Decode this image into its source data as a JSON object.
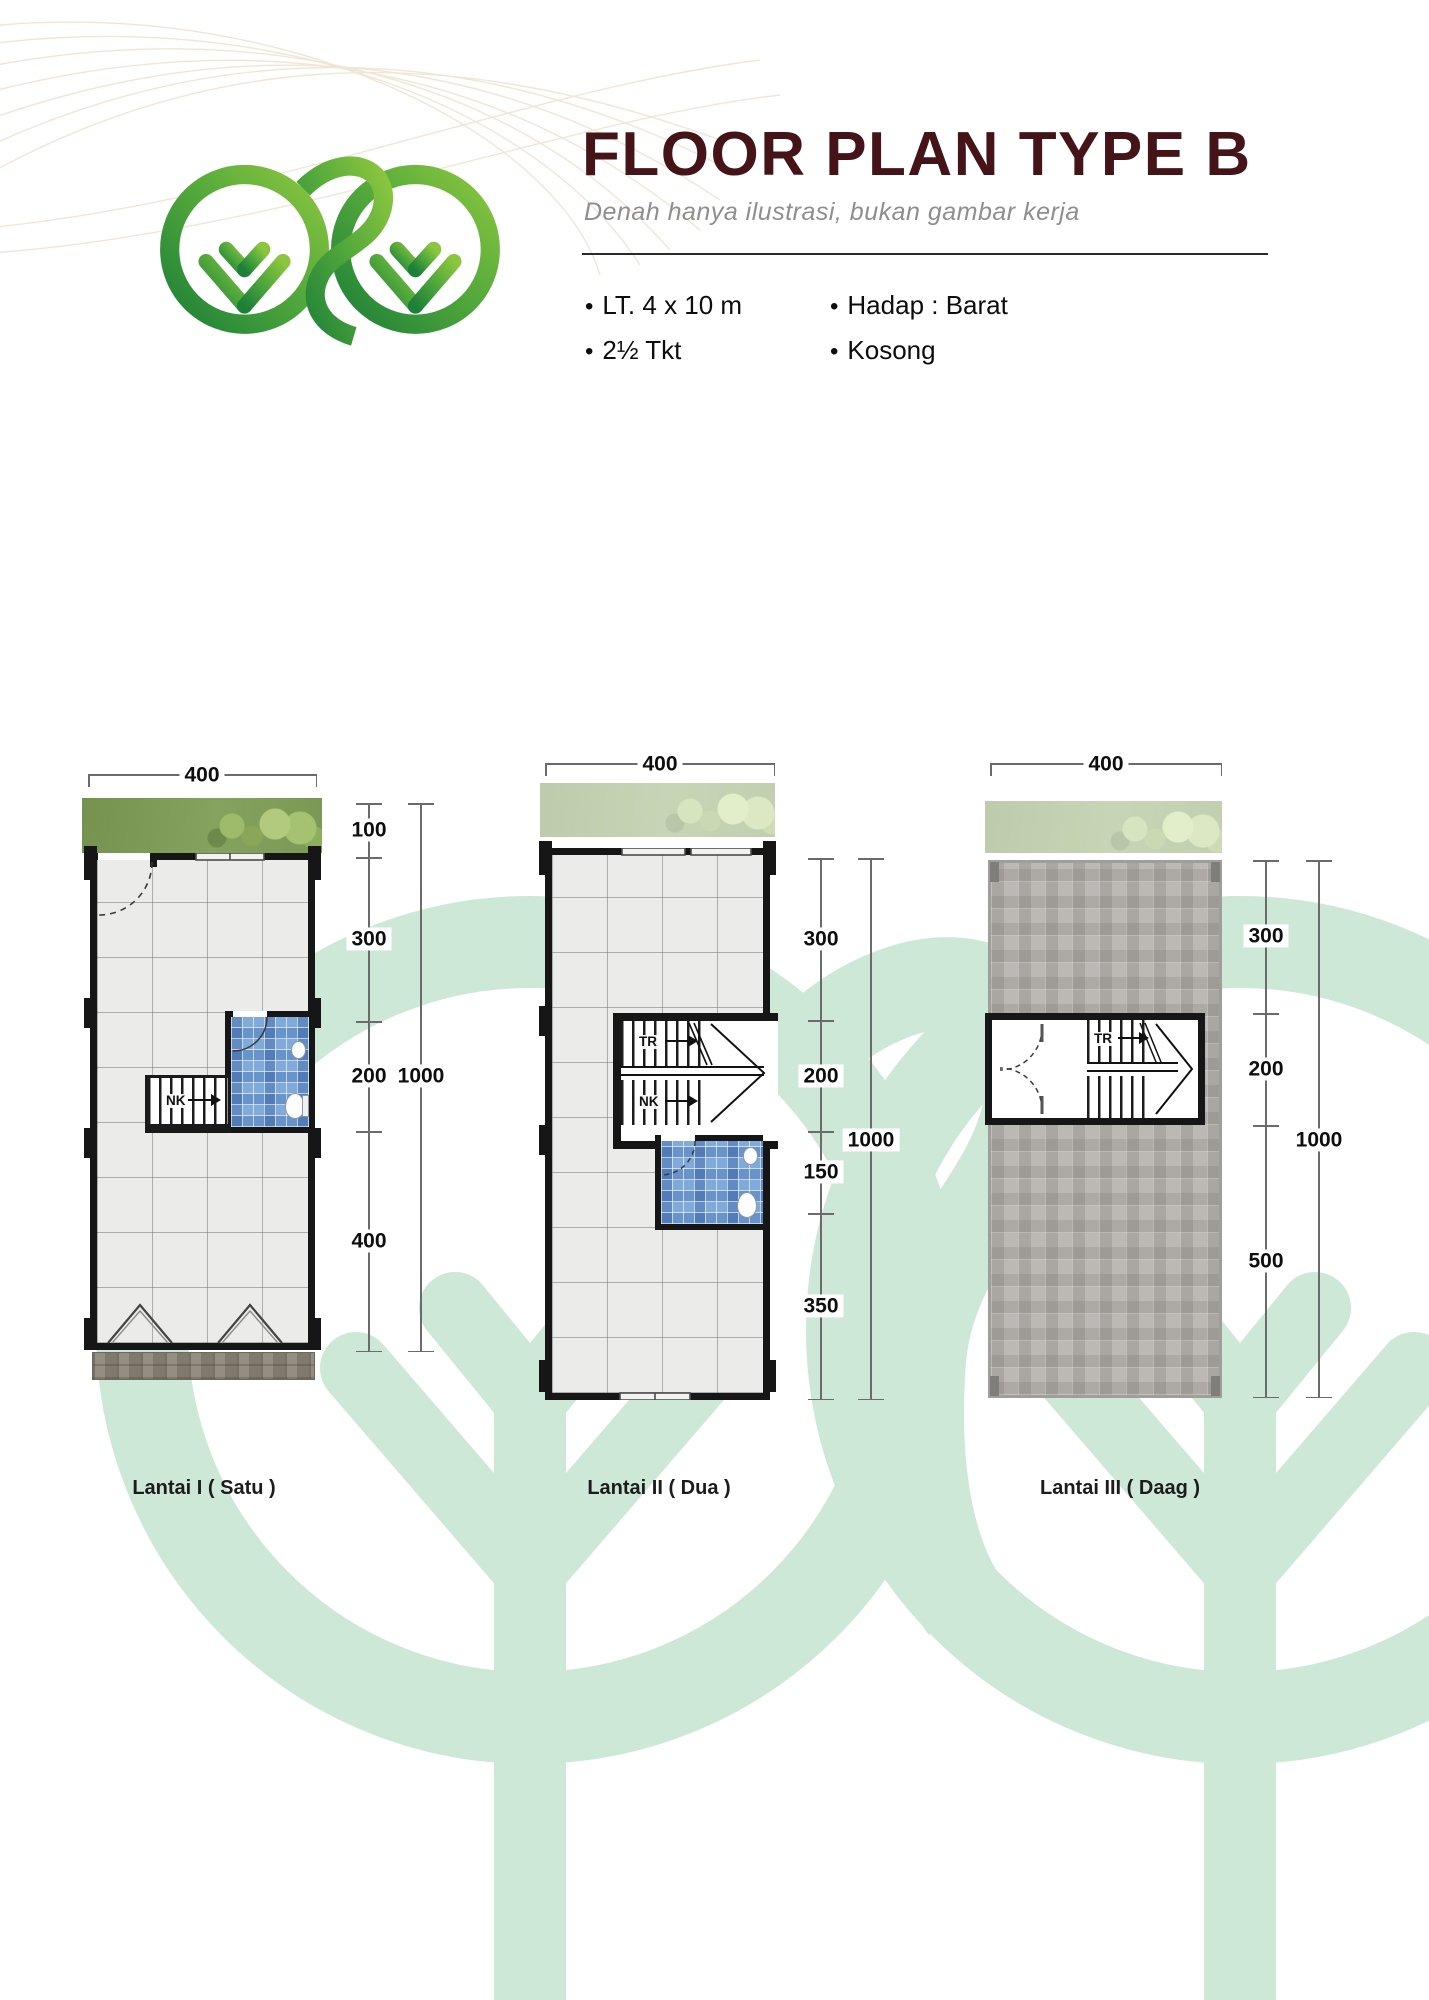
{
  "header": {
    "title": "FLOOR PLAN TYPE B",
    "subtitle": "Denah hanya ilustrasi, bukan gambar kerja",
    "specs": [
      {
        "bullet": "•",
        "label": "LT. 4 x 10 m"
      },
      {
        "bullet": "•",
        "label": "2½ Tkt"
      },
      {
        "bullet": "•",
        "label": "Hadap : Barat"
      },
      {
        "bullet": "•",
        "label": "Kosong"
      }
    ]
  },
  "plans": [
    {
      "name": "Lantai I ( Satu )",
      "top_dim": "400",
      "segments": [
        "100",
        "300",
        "200",
        "400"
      ],
      "total": "1000",
      "stairs": {
        "nk": "NK"
      }
    },
    {
      "name": "Lantai II ( Dua )",
      "top_dim": "400",
      "segments": [
        "300",
        "200",
        "150",
        "350"
      ],
      "total": "1000",
      "stairs": {
        "tr": "TR",
        "nk": "NK"
      }
    },
    {
      "name": "Lantai III ( Daag )",
      "top_dim": "400",
      "segments": [
        "300",
        "200",
        "500"
      ],
      "total": "1000",
      "stairs": {
        "tr": "TR"
      }
    }
  ],
  "colors": {
    "title_maroon": "#451418",
    "logo_green_dark": "#1d8038",
    "logo_green_light": "#8cc63f",
    "watermark_green": "#cde8d7",
    "bathroom_blue": "#80aada",
    "grass_green": "#7e9a58",
    "roof_gray": "#bcb9b4",
    "wall_black": "#161616"
  }
}
